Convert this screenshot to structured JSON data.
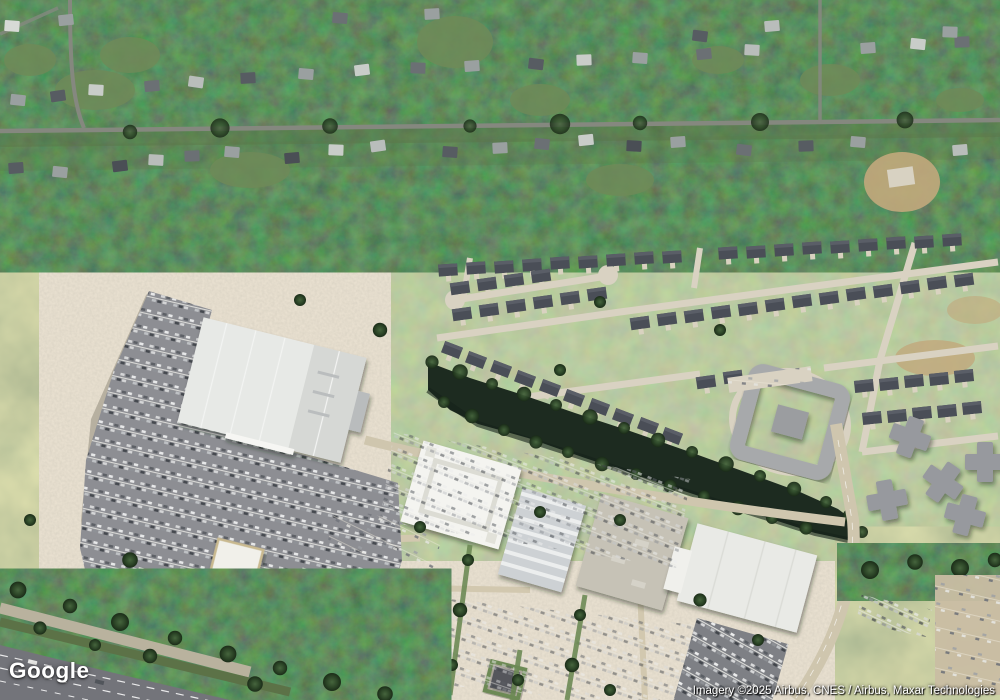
{
  "page": {
    "type": "satellite-map-view",
    "zoom_context": "aerial imagery of suburban retail and residential area"
  },
  "branding": {
    "logo_text": "Google"
  },
  "attribution": {
    "text": "Imagery ©2025 Airbus, CNES / Airbus, Maxar Technologies"
  },
  "colors": {
    "c-forest": "#2c432b",
    "c-pond": "#1d2b20",
    "c-street": "#d9d2c2",
    "c-asphalt": "#8d8e93",
    "c-tan": "#c9bda3",
    "c-roof-white": "#eceee9",
    "c-roof-dark": "#4b4f58",
    "c-roof-gray": "#a8abac",
    "c-highway": "#73747a",
    "c-logo": "#ffffff",
    "c-attr": "#ffffff"
  },
  "map_features": [
    {
      "name": "forest-area",
      "description": "dense tree canopy with older residential streets, top half"
    },
    {
      "name": "residential-road",
      "description": "east-west neighborhood road through trees"
    },
    {
      "name": "new-subdivision",
      "description": "rows of dark-roofed houses with light concrete streets and cul-de-sacs, middle right"
    },
    {
      "name": "apartment-complex",
      "description": "square ring-shaped complex with courtyard"
    },
    {
      "name": "pond",
      "description": "dark retention pond running diagonally, tree-lined banks"
    },
    {
      "name": "big-box-store",
      "description": "large white-roofed anchor store with gray striped parking lot"
    },
    {
      "name": "strip-mall",
      "description": "row of large white and gray retail roofs with tan parking fields"
    },
    {
      "name": "outparcel-buildings",
      "description": "small white restaurant/retail pads near highway"
    },
    {
      "name": "highway",
      "description": "multi-lane highway with tree-lined boulevard, bottom left corner"
    },
    {
      "name": "vacant-field",
      "description": "scrubby green-tan cleared land, left middle"
    }
  ]
}
